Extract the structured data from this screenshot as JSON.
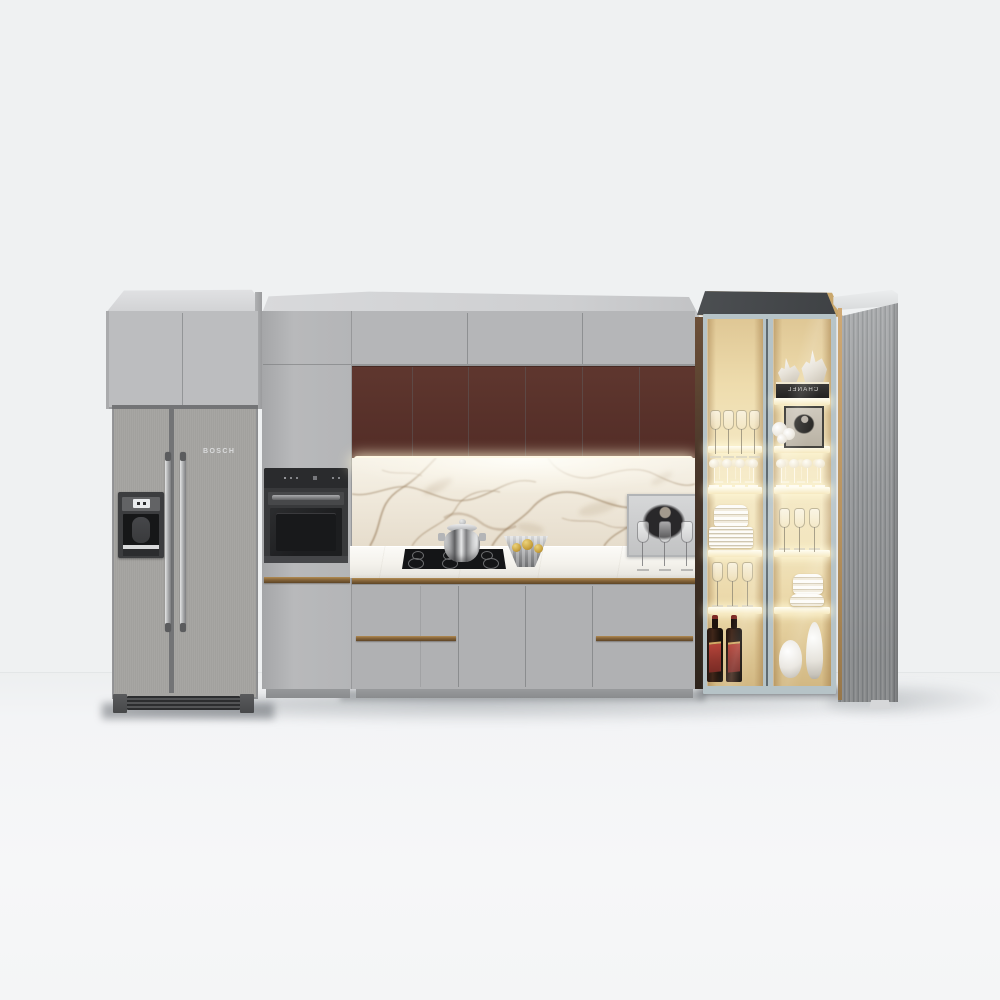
{
  "scene": {
    "type": "3d-kitchen-render",
    "wall_color": "#eff1f2",
    "floor_color": "#f4f5f6"
  },
  "refrigerator": {
    "brand_label": "BOSCH",
    "style": "side-by-side",
    "body_color": "#a9a8a5",
    "features": [
      "water-ice-dispenser",
      "vertical-bar-handles",
      "ventilation-grille"
    ]
  },
  "appliances": {
    "wall_oven_color": "#38393b",
    "cooktop_color": "#141517",
    "cooktop_burners": 6
  },
  "cabinets": {
    "upper_color": "#b5b6b8",
    "accent_door_color": "#59322b",
    "accent_door_count": 6,
    "base_color": "#b0b1b3",
    "handle_color": "#8a683c",
    "top_cap_color": "#d3d4d6"
  },
  "backsplash": {
    "material": "marble",
    "base_color": "#efe8da",
    "vein_color": "#7d5c36"
  },
  "countertop": {
    "material": "marble",
    "color": "#f5f3ef",
    "items": [
      "steel-pot",
      "metal-fruit-bowl",
      "framed-photo",
      "wine-glasses"
    ]
  },
  "display_cabinet": {
    "box_label": "CHANEL",
    "box_label_mirrored": true,
    "frame_color": "#b6c3c7",
    "roof_color": "#45484b",
    "interior_glow_color": "#eedcad",
    "shelf_items": [
      "figurines",
      "wine-glasses",
      "framed-photo",
      "coupe-glasses",
      "plate-stack",
      "bowl-stack",
      "whisky-bottles",
      "white-vases"
    ]
  },
  "fluted_panel": {
    "color": "#979a9c",
    "light_spill_color": "#c9a76c"
  }
}
